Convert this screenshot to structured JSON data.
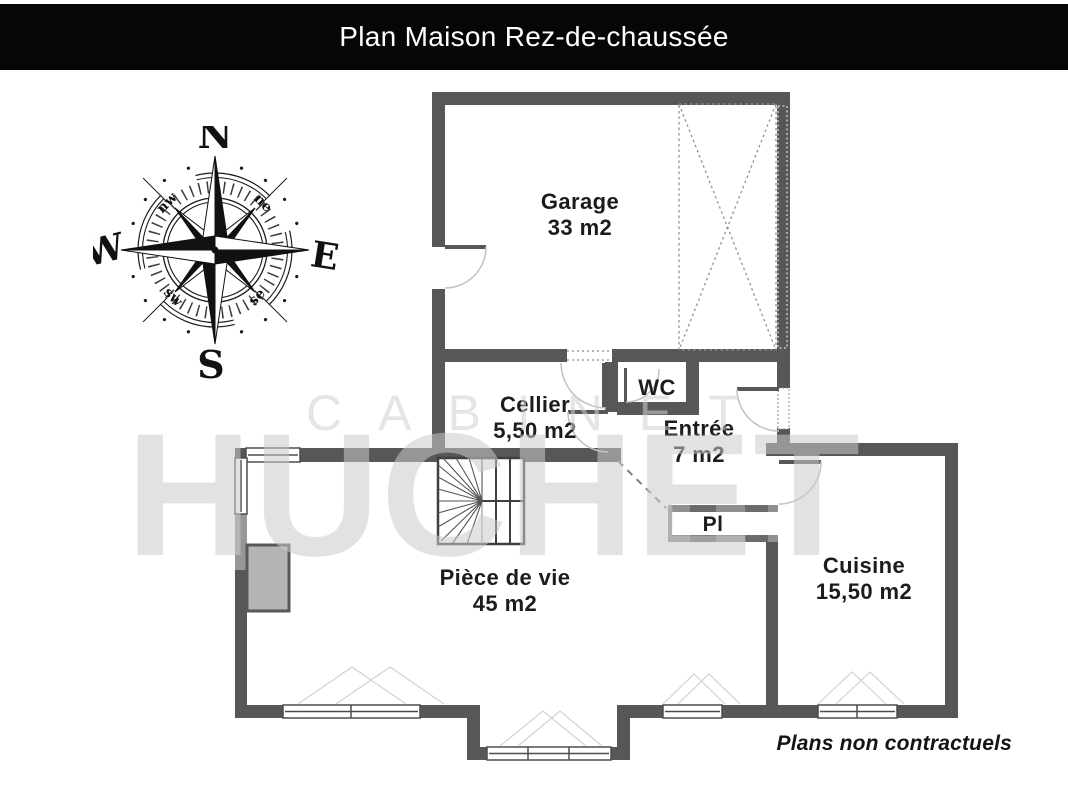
{
  "title_bar": {
    "title": "Plan Maison Rez-de-chaussée"
  },
  "compass": {
    "cardinals": {
      "north": "N",
      "south": "S",
      "west": "W",
      "east": "E"
    },
    "intercardinals": {
      "northwest": "nw",
      "northeast": "ne",
      "southwest": "sw",
      "southeast": "se"
    }
  },
  "rooms": {
    "garage": {
      "name": "Garage",
      "area": "33 m2"
    },
    "cellier": {
      "name": "Cellier",
      "area": "5,50 m2"
    },
    "wc": {
      "name": "WC"
    },
    "entree": {
      "name": "Entrée",
      "area": "7 m2"
    },
    "placard": {
      "name": "Pl"
    },
    "piece_de_vie": {
      "name": "Pièce de vie",
      "area": "45 m2"
    },
    "cuisine": {
      "name": "Cuisine",
      "area": "15,50 m2"
    }
  },
  "watermark": {
    "line1": "CABINET",
    "line2": "HUCHET"
  },
  "footer": {
    "disclaimer": "Plans non contractuels"
  },
  "colors": {
    "wall": "#57575a",
    "title_bar_bg": "#060606",
    "title_text": "#ffffff",
    "label_text": "#1c1c1e",
    "watermark": "#e3e3e4"
  }
}
